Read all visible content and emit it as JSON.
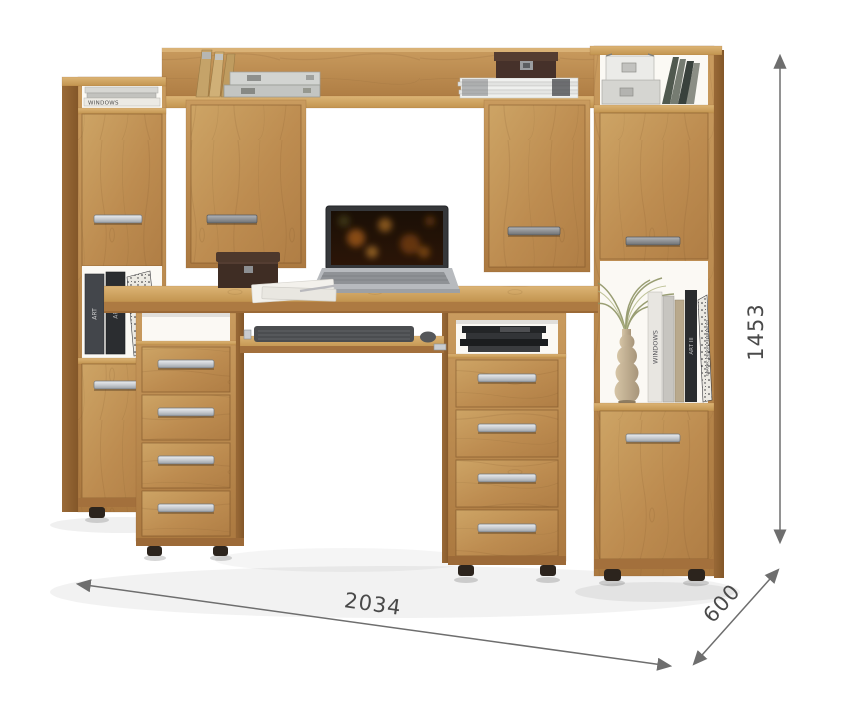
{
  "subject": "wooden computer desk wall unit with bookshelf towers, laptop and decor",
  "background_color": "#ffffff",
  "dims": {
    "width": "2034",
    "depth": "600",
    "height": "1453"
  },
  "annotation": {
    "line_color": "#6e6e6e",
    "text_color": "#4a4a4a"
  },
  "palette": {
    "wood_light": "#d8ae72",
    "wood_mid": "#bc8a50",
    "wood_dark": "#8f6234",
    "handle_metal": "#cdd1d5",
    "interior_white": "#fbf9f4",
    "feet": "#2c241d",
    "laptop_body": "#b7babe",
    "laptop_screen_glow": "#d97a1e"
  },
  "book_spines": {
    "windows": "WINDOWS",
    "art": "ART",
    "art_iii": "ART III",
    "graphic_design": "GRAPHIC DESIGN REFERENCED"
  }
}
